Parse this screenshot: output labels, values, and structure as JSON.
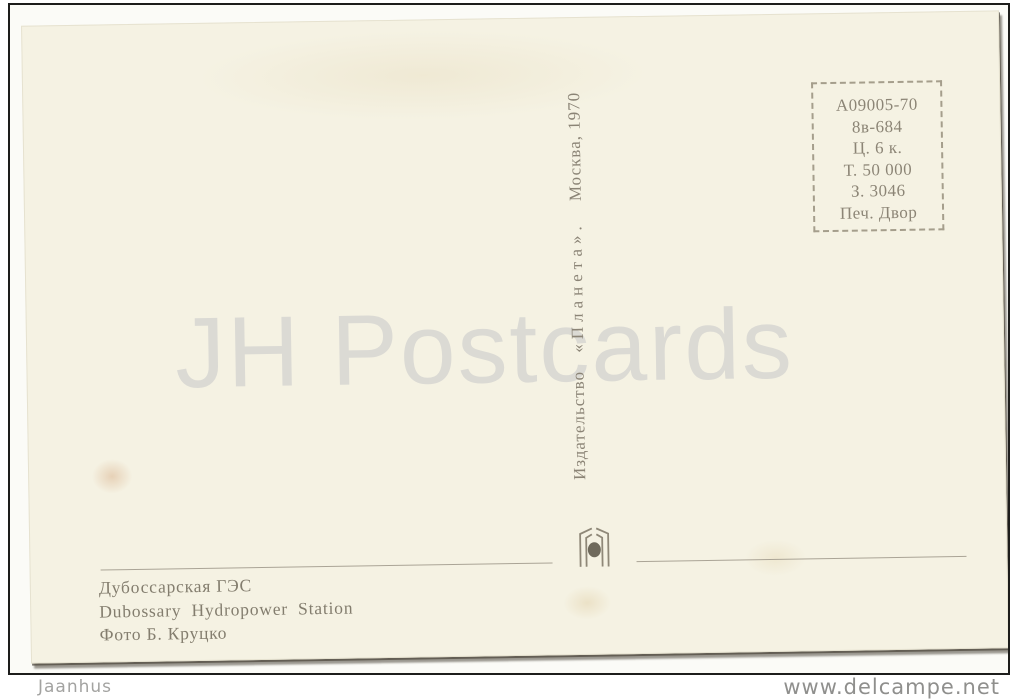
{
  "watermark_text": "JH Postcards",
  "postcard": {
    "print_info_box": {
      "lines": [
        "А09005-70",
        "8в-684",
        "Ц. 6 к.",
        "Т. 50 000",
        "З. 3046",
        "Печ. Двор"
      ]
    },
    "publisher_imprint": {
      "prefix": "Издательство",
      "name": "«Планета».",
      "suffix": "Москва, 1970"
    },
    "caption": {
      "title_ru": "Дубоссарская ГЭС",
      "title_en": "Dubossary Hydropower Station",
      "credit": "Фото Б. Круцко"
    }
  },
  "overlay": {
    "seller": "Jaanhus",
    "site": "www.delcampe.net"
  },
  "colors": {
    "card_bg": "#f5f2e3",
    "ink": "#8c8576",
    "caption_ink": "#837d6e",
    "watermark": "#dbdad4",
    "frame": "#1d1d1b",
    "overlay_text": "#9a9a98"
  }
}
